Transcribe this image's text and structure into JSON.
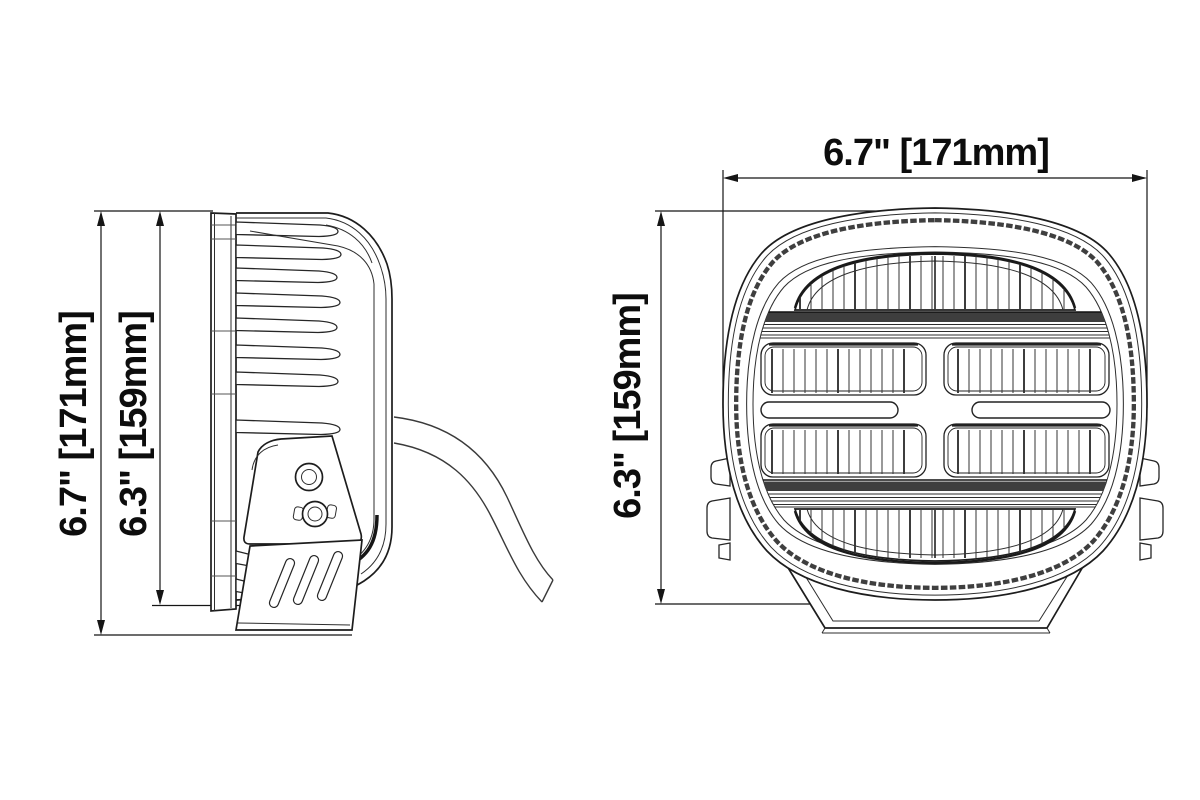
{
  "colors": {
    "background": "#ffffff",
    "line": "#1f1f1f",
    "text": "#0d0d0d"
  },
  "side_view": {
    "outer_height_label": "6.7\" [171mm]",
    "inner_height_label": "6.3\" [159mm]"
  },
  "front_view": {
    "width_label": "6.7\" [171mm]",
    "height_label": "6.3\" [159mm]"
  }
}
